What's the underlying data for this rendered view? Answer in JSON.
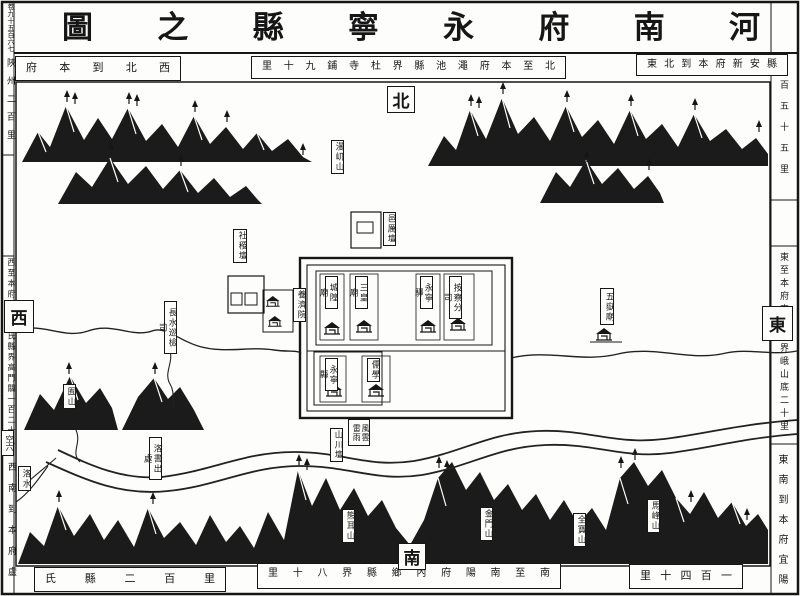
{
  "title": {
    "displayed": "圖之縣寧永府南河",
    "reading": "河南府永寧縣之圖"
  },
  "corner_marker": "卷九十五百六七",
  "page_marker_small": "空六",
  "compass": {
    "north": "北",
    "south": "南",
    "east": "東",
    "west": "西"
  },
  "border_notes": {
    "top_left_strip": "府本到北西",
    "top_left_edge": "陜州二百里",
    "top_left_reading": "西北到本府陜州二百里",
    "top_center_strip": "里十九鋪寺杜界縣池澠府本至北",
    "top_center_reading": "北至本府澠池縣界杜寺鋪九十里",
    "top_right_strip": "東北到本府新安縣",
    "top_right_edge": "百五十五里",
    "left_middle_edge": "西至本府陝州盧氏縣界高門關一百二十里",
    "right_middle_edge": "東至本府宜陽縣界峨山底二十里",
    "bottom_left_edge": "西南到本府盧",
    "bottom_left_strip": "氏縣二百里",
    "bottom_left_reading": "西南到本府盧氏縣二百里",
    "bottom_center_strip": "里十八界縣鄉內府陽南至南",
    "bottom_center_reading": "南至南陽府內鄉縣界八十里",
    "bottom_right_strip": "里十四百一",
    "bottom_right_edge": "東南到本府宜陽",
    "bottom_right_reading": "東南到本府宜陽一百四十里"
  },
  "city": {
    "compounds": [
      {
        "label": "城隍廟"
      },
      {
        "label": "三皇廟"
      },
      {
        "label": "永寧驛"
      },
      {
        "label": "按察分司"
      },
      {
        "label": "永寧縣"
      },
      {
        "label": "儒學"
      }
    ]
  },
  "landmarks": [
    {
      "label": "邑厲壇"
    },
    {
      "label": "社稷壇"
    },
    {
      "label": "養濟院"
    },
    {
      "label": "五嶽廟"
    },
    {
      "label": "風雲雷雨"
    },
    {
      "label": "山川壇"
    },
    {
      "label": "長水巡檢司"
    },
    {
      "label": "洛書出處"
    }
  ],
  "mountains": [
    {
      "label": "漫屼山"
    },
    {
      "label": "囿山"
    },
    {
      "label": "熊耳山"
    },
    {
      "label": "金門山"
    },
    {
      "label": "全寶山"
    },
    {
      "label": "馬峰山"
    }
  ],
  "rivers": [
    {
      "label": "洛水"
    }
  ],
  "colors": {
    "ink": "#161616",
    "paper": "#fdfdfb"
  }
}
